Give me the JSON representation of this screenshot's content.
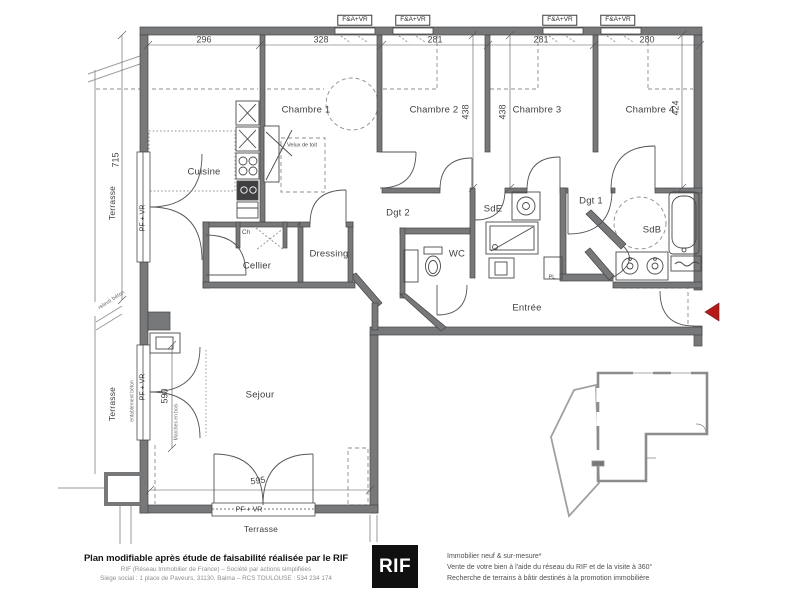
{
  "plan": {
    "labels": [
      {
        "id": "dim-296",
        "text": "296",
        "x": 204,
        "y": 40,
        "rot": 0,
        "size": 9,
        "cls": "dim"
      },
      {
        "id": "dim-328",
        "text": "328",
        "x": 321,
        "y": 40,
        "rot": 0,
        "size": 9,
        "cls": "dim"
      },
      {
        "id": "dim-281-a",
        "text": "281",
        "x": 435,
        "y": 40,
        "rot": 0,
        "size": 9,
        "cls": "dim"
      },
      {
        "id": "dim-281-b",
        "text": "281",
        "x": 541,
        "y": 40,
        "rot": 0,
        "size": 9,
        "cls": "dim"
      },
      {
        "id": "dim-280",
        "text": "280",
        "x": 647,
        "y": 40,
        "rot": 0,
        "size": 9,
        "cls": "dim"
      },
      {
        "id": "dim-715",
        "text": "715",
        "x": 116,
        "y": 160,
        "rot": -90,
        "size": 9,
        "cls": "dim"
      },
      {
        "id": "dim-438-a",
        "text": "438",
        "x": 466,
        "y": 112,
        "rot": -90,
        "size": 9,
        "cls": "dim"
      },
      {
        "id": "dim-438-b",
        "text": "438",
        "x": 503,
        "y": 112,
        "rot": -90,
        "size": 9,
        "cls": "dim"
      },
      {
        "id": "dim-424",
        "text": "424",
        "x": 676,
        "y": 108,
        "rot": -90,
        "size": 9,
        "cls": "dim"
      },
      {
        "id": "dim-590",
        "text": "590",
        "x": 165,
        "y": 396,
        "rot": -90,
        "size": 9,
        "cls": "dim"
      },
      {
        "id": "dim-595",
        "text": "595",
        "x": 258,
        "y": 481,
        "rot": -7,
        "size": 9,
        "cls": "dim"
      },
      {
        "id": "room-chambre-1",
        "text": "Chambre 1",
        "x": 306,
        "y": 110,
        "rot": 0,
        "size": 9.5,
        "cls": "room"
      },
      {
        "id": "room-chambre-2",
        "text": "Chambre 2",
        "x": 434,
        "y": 110,
        "rot": 0,
        "size": 9.5,
        "cls": "room"
      },
      {
        "id": "room-chambre-3",
        "text": "Chambre 3",
        "x": 537,
        "y": 110,
        "rot": 0,
        "size": 9.5,
        "cls": "room"
      },
      {
        "id": "room-chambre-4",
        "text": "Chambre 4",
        "x": 650,
        "y": 110,
        "rot": 0,
        "size": 9.5,
        "cls": "room"
      },
      {
        "id": "room-cuisine",
        "text": "Cuisine",
        "x": 204,
        "y": 172,
        "rot": 0,
        "size": 9.5,
        "cls": "room"
      },
      {
        "id": "room-cellier",
        "text": "Cellier",
        "x": 257,
        "y": 266,
        "rot": 0,
        "size": 9.5,
        "cls": "room"
      },
      {
        "id": "room-dressing",
        "text": "Dressing",
        "x": 329,
        "y": 254,
        "rot": 0,
        "size": 9.5,
        "cls": "room"
      },
      {
        "id": "room-dgt-2",
        "text": "Dgt 2",
        "x": 398,
        "y": 213,
        "rot": 0,
        "size": 9.5,
        "cls": "room"
      },
      {
        "id": "room-sde",
        "text": "SdE",
        "x": 493,
        "y": 209,
        "rot": 0,
        "size": 9.5,
        "cls": "room"
      },
      {
        "id": "room-wc",
        "text": "WC",
        "x": 457,
        "y": 254,
        "rot": 0,
        "size": 9.5,
        "cls": "room"
      },
      {
        "id": "room-dgt-1",
        "text": "Dgt 1",
        "x": 591,
        "y": 201,
        "rot": 0,
        "size": 9.5,
        "cls": "room"
      },
      {
        "id": "room-sdb",
        "text": "SdB",
        "x": 652,
        "y": 230,
        "rot": 0,
        "size": 9.5,
        "cls": "room"
      },
      {
        "id": "room-entree",
        "text": "Entrée",
        "x": 527,
        "y": 308,
        "rot": 0,
        "size": 9.5,
        "cls": "room"
      },
      {
        "id": "room-sejour",
        "text": "Sejour",
        "x": 260,
        "y": 395,
        "rot": 0,
        "size": 9.5,
        "cls": "room"
      },
      {
        "id": "terrasse-left-top",
        "text": "Terrasse",
        "x": 112,
        "y": 203,
        "rot": -90,
        "size": 8.5,
        "cls": "room"
      },
      {
        "id": "terrasse-left-bottom",
        "text": "Terrasse",
        "x": 112,
        "y": 404,
        "rot": -90,
        "size": 8.5,
        "cls": "room"
      },
      {
        "id": "terrasse-bottom",
        "text": "Terrasse",
        "x": 261,
        "y": 529,
        "rot": 0,
        "size": 8.5,
        "cls": "room"
      },
      {
        "id": "badge-fa-vr-1",
        "text": "F&A+VR",
        "x": 355,
        "y": 20,
        "rot": 0,
        "size": 6.5,
        "cls": "badge"
      },
      {
        "id": "badge-fa-vr-2",
        "text": "F&A+VR",
        "x": 413,
        "y": 20,
        "rot": 0,
        "size": 6.5,
        "cls": "badge"
      },
      {
        "id": "badge-fa-vr-3",
        "text": "F&A+VR",
        "x": 560,
        "y": 20,
        "rot": 0,
        "size": 6.5,
        "cls": "badge"
      },
      {
        "id": "badge-fa-vr-4",
        "text": "F&A+VR",
        "x": 618,
        "y": 20,
        "rot": 0,
        "size": 6.5,
        "cls": "badge"
      },
      {
        "id": "badge-pf-vr-left-1",
        "text": "PF + VR",
        "x": 143,
        "y": 218,
        "rot": -90,
        "size": 7,
        "cls": "win"
      },
      {
        "id": "badge-pf-vr-left-2",
        "text": "PF + VR",
        "x": 143,
        "y": 387,
        "rot": -90,
        "size": 7,
        "cls": "win"
      },
      {
        "id": "badge-pf-vr-bottom",
        "text": "PF + VR",
        "x": 249,
        "y": 510,
        "rot": 0,
        "size": 7,
        "cls": "win"
      },
      {
        "id": "note-ch",
        "text": "Ch",
        "x": 246,
        "y": 233,
        "rot": 0,
        "size": 6.5,
        "cls": "small"
      },
      {
        "id": "note-velux",
        "text": "Velux de toit",
        "x": 302,
        "y": 146,
        "rot": 0,
        "size": 5.5,
        "cls": "small"
      },
      {
        "id": "note-pl",
        "text": "PL",
        "x": 552,
        "y": 278,
        "rot": 0,
        "size": 5.5,
        "cls": "small"
      },
      {
        "id": "note-releve-beton",
        "text": "relevé béton",
        "x": 112,
        "y": 301,
        "rot": -33,
        "size": 5.5,
        "cls": "tiny"
      },
      {
        "id": "note-entablement-beton",
        "text": "entablement béton",
        "x": 133,
        "y": 401,
        "rot": -90,
        "size": 5,
        "cls": "tiny"
      },
      {
        "id": "note-marches-bois",
        "text": "Marches en bois",
        "x": 177,
        "y": 422,
        "rot": -90,
        "size": 5,
        "cls": "tiny"
      }
    ]
  },
  "footer": {
    "title": "Plan modifiable après étude de faisabilité réalisée par le RIF",
    "company_line": "RIF (Réseau Immobilier de France) – Société par actions simplifiées",
    "address_line": "Siège social : 1 place de Paveurs, 31130, Balma – RCS TOULOUSE : 534 234 174",
    "logo_text": "RIF",
    "services": [
      "Immobilier neuf & sur-mesure*",
      "Vente de votre bien à l'aide du réseau du RIF et de la visite à 360°",
      "Recherche de terrains à bâtir destinés à la promotion immobilière"
    ]
  },
  "colors": {
    "accent_red": "#b51a1a",
    "wall_gray": "#77787a"
  }
}
